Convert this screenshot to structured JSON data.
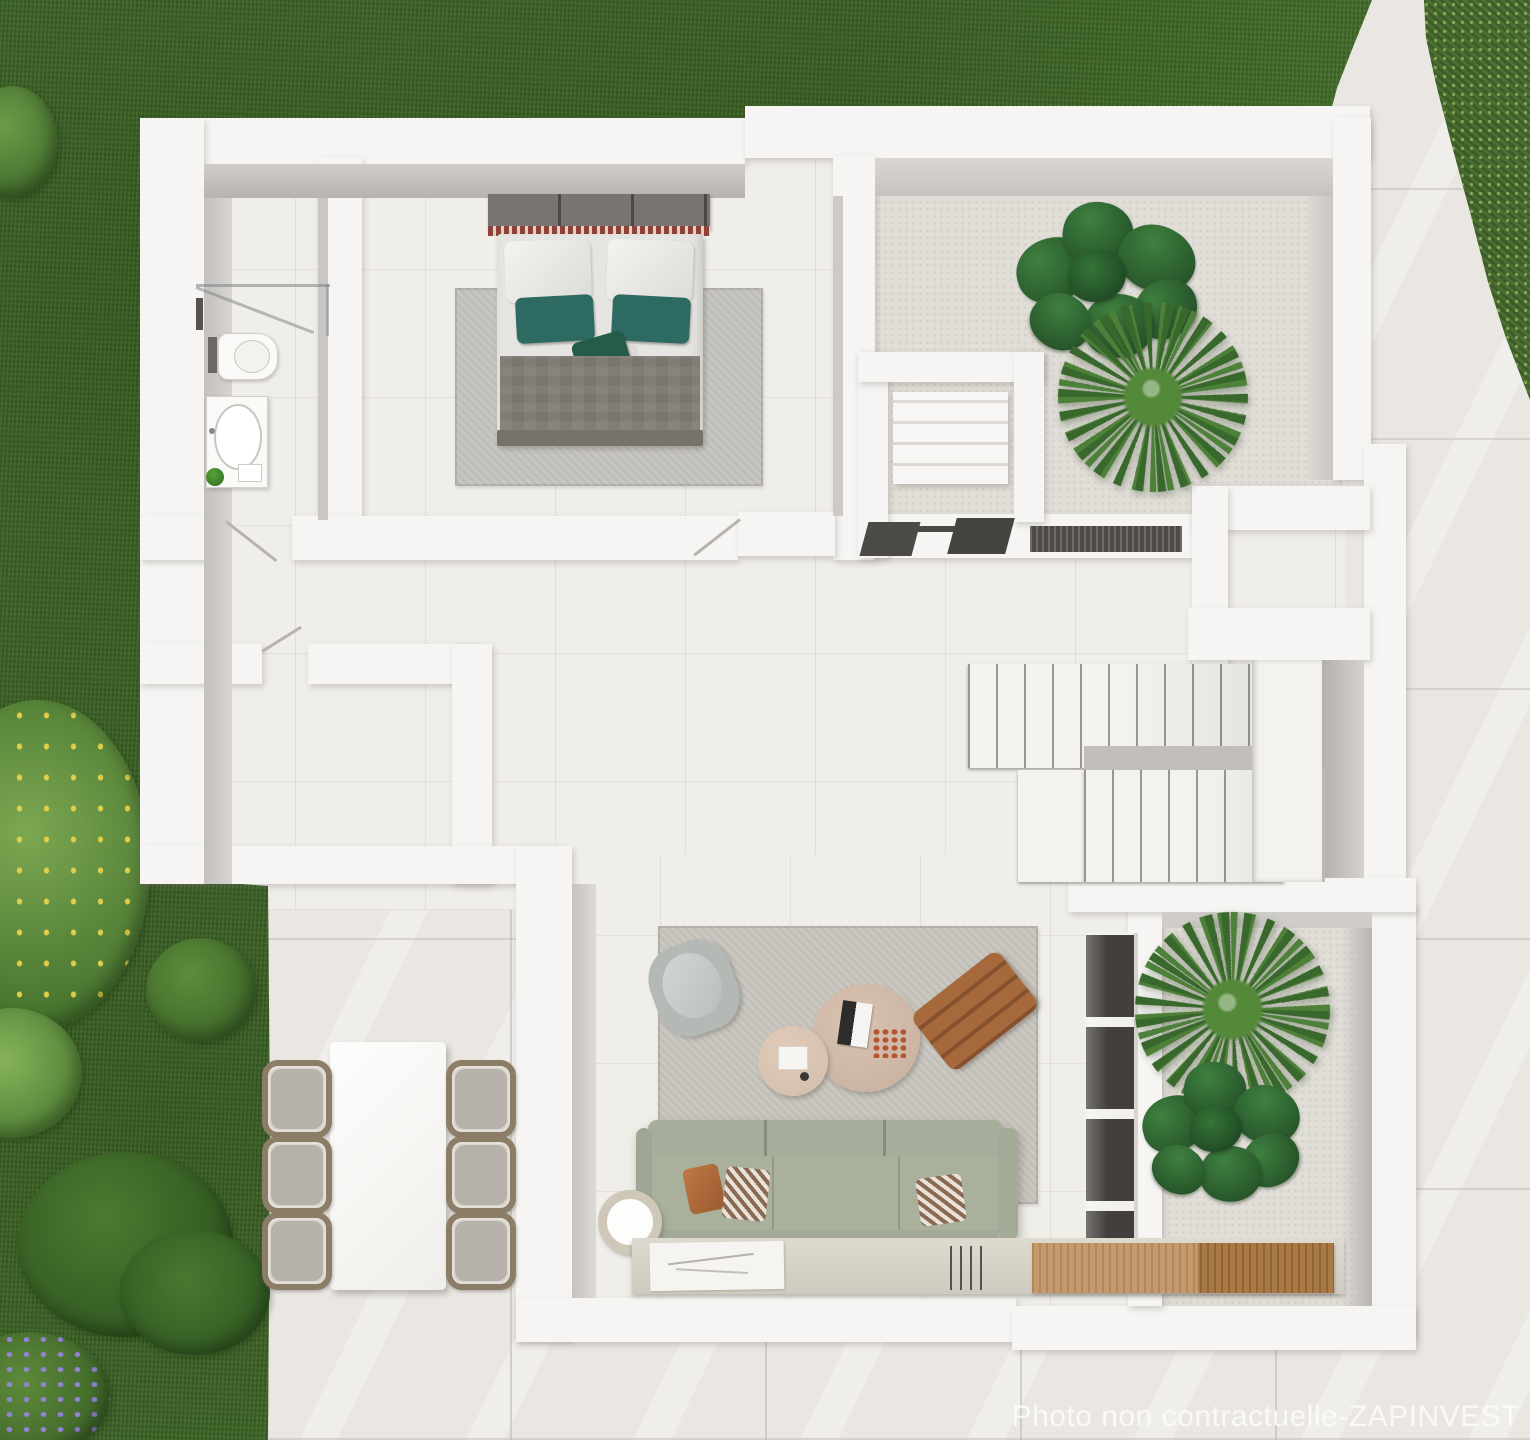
{
  "watermark": {
    "text": "Photo non contractuelle-ZAPINVEST"
  },
  "palette": {
    "lawn": "#456d2c",
    "hedge": "#4b7430",
    "paving": "#eae7e3",
    "floor": "#f0eee9",
    "concrete": "#e1ded8",
    "wall": "#f6f5f3",
    "wall_face": "#c8c5c2",
    "stair": "#f3f2ef",
    "sofa": "#a9b09c",
    "rug": "#c8c5be",
    "bedroom_rug": "#c5c3bd",
    "duvet": "#e6e5e1",
    "blanket": "#7a756d",
    "teal_pillow": "#2d6a62",
    "headboard": "#787470",
    "headboard_trim": "#8f4238",
    "coffee_table": "#ccb4a3",
    "coffee_table_small": "#d6c0ae",
    "lounger_rust": "#a5693c",
    "armchair": "#b4b9b6",
    "wicker": "#8c7d67",
    "chair_cushion": "#b6b1aa",
    "wood_mat": "#b8834a",
    "glazing": "#423f3c",
    "watermark_color": "#fbfbfa"
  },
  "counts": {
    "dining_chairs": 6,
    "stair_flights": 2,
    "courtyard_plants": 2,
    "planter_plants": 2,
    "sofa_throw_pillows": 3
  }
}
